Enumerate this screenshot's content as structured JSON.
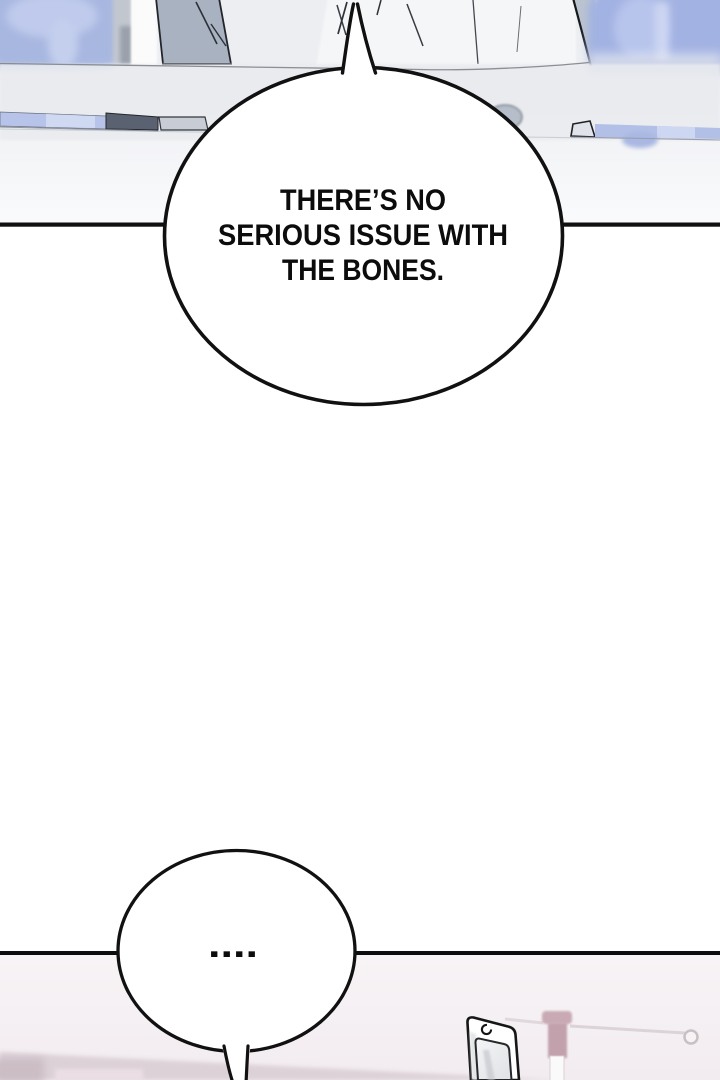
{
  "comic": {
    "bubbles": [
      {
        "lines": [
          "THERE’S NO",
          "SERIOUS ISSUE WITH",
          "THE BONES."
        ]
      },
      {
        "text": "...."
      }
    ],
    "palette": {
      "page_background": "#ffffff",
      "panel1_background": "#edeff2",
      "figure_blue": "#aab9e2",
      "monitor_gray": "#a8b2c0",
      "desk_gray": "#e9ebef",
      "desk_item_dark": "#5a6170",
      "desk_item_blue": "#b2bfe6",
      "panel2_background": "#f5eff2",
      "floor_mauve": "#dcd1d7",
      "iv_stand_mauve": "#c6a6b1",
      "outline_black": "#111111"
    }
  }
}
